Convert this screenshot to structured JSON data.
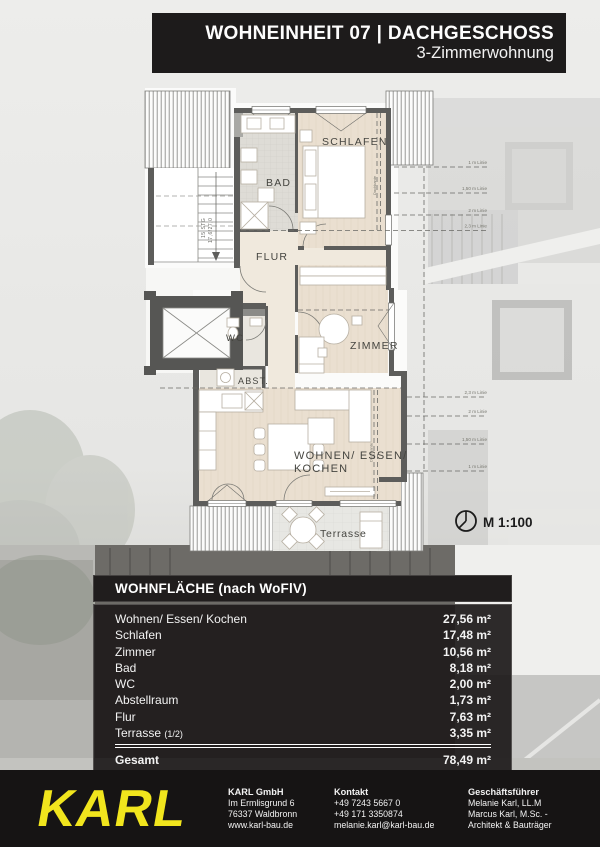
{
  "header": {
    "title": "WOHNEINHEIT 07 | DACHGESCHOSS",
    "subtitle": "3-Zimmerwohnung"
  },
  "plan": {
    "rooms": {
      "schlafen": "SCHLAFEN",
      "bad": "BAD",
      "flur": "FLUR",
      "wc": "WC",
      "abst": "ABST.",
      "zimmer": "ZIMMER",
      "wohnen_line1": "WOHNEN/ ESSEN/",
      "wohnen_line2": "KOCHEN",
      "terrasse": "Terrasse"
    },
    "stair_note_line1": "15 STG",
    "stair_note_line2": "17,6/27,0",
    "roof_lines_top": [
      "1 m Linie",
      "1,50 m Linie",
      "2 m Linie",
      "2,3 m Linie"
    ],
    "roof_lines_bottom": [
      "2,3 m Linie",
      "2 m Linie",
      "1,50 m Linie",
      "1 m Linie"
    ],
    "roof_edge_label": "Dachkante",
    "scale_label": "M 1:100"
  },
  "area_table": {
    "title": "WOHNFLÄCHE (nach WoFlV)",
    "rows": [
      {
        "label": "Wohnen/ Essen/ Kochen",
        "value": "27,56 m²"
      },
      {
        "label": "Schlafen",
        "value": "17,48 m²"
      },
      {
        "label": "Zimmer",
        "value": "10,56 m²"
      },
      {
        "label": "Bad",
        "value": "8,18 m²"
      },
      {
        "label": "WC",
        "value": "2,00 m²"
      },
      {
        "label": "Abstellraum",
        "value": "1,73 m²"
      },
      {
        "label": "Flur",
        "value": "7,63 m²"
      },
      {
        "label": "Terrasse",
        "label_suffix": "(1/2)",
        "value": "3,35 m²"
      }
    ],
    "total": {
      "label": "Gesamt",
      "value": "78,49 m²"
    }
  },
  "footer": {
    "logo": "KARL",
    "company": {
      "title": "KARL GmbH",
      "lines": [
        "Im Ermlisgrund 6",
        "76337 Waldbronn",
        "www.karl-bau.de"
      ]
    },
    "contact": {
      "title": "Kontakt",
      "lines": [
        "+49 7243 5667 0",
        "+49 171 3350874",
        "melanie.karl@karl-bau.de"
      ]
    },
    "management": {
      "title": "Geschäftsführer",
      "lines": [
        "Melanie Karl, LL.M",
        "Marcus Karl, M.Sc. -",
        "Architekt & Bauträger"
      ]
    }
  },
  "colors": {
    "bar_black": "#1d1b1b",
    "logo_yellow": "#f1e51d",
    "wall_gray": "#5d5d5b",
    "room_beige": "#eadfd0",
    "bath_gray": "#dedcd6",
    "terrace_gray": "#e7e7e3"
  }
}
